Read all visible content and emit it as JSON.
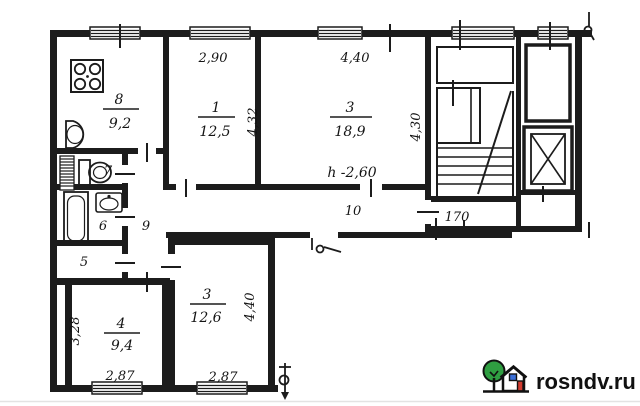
{
  "watermark": {
    "site": "rosndv.ru"
  },
  "colors": {
    "ink": "#1c1c1c",
    "tree_green": "#2f9e41",
    "door_red": "#d23b2f",
    "window_blue": "#3a6fd8"
  },
  "labels": {
    "kitchen_number": "8",
    "kitchen_area": "9,2",
    "room1_number": "1",
    "room1_area": "12,5",
    "room3_number": "3",
    "room3_area": "18,9",
    "room3b_number": "3",
    "room3b_area": "12,6",
    "room4_number": "4",
    "room4_area": "9,4",
    "wc_number": "7",
    "bath_number": "6",
    "closet_number": "5",
    "hall_number": "9",
    "corridor_number": "10",
    "lobby_number": "170",
    "height_note": "h -2,60",
    "dim_room1_w": "2,90",
    "dim_room1_d": "4,32",
    "dim_room3_w": "4,40",
    "dim_room3_d": "4,30",
    "dim_room3b_d": "4,40",
    "dim_room3b_w": "2,87",
    "dim_room4_d": "3,28",
    "dim_room4_w": "2,87"
  }
}
